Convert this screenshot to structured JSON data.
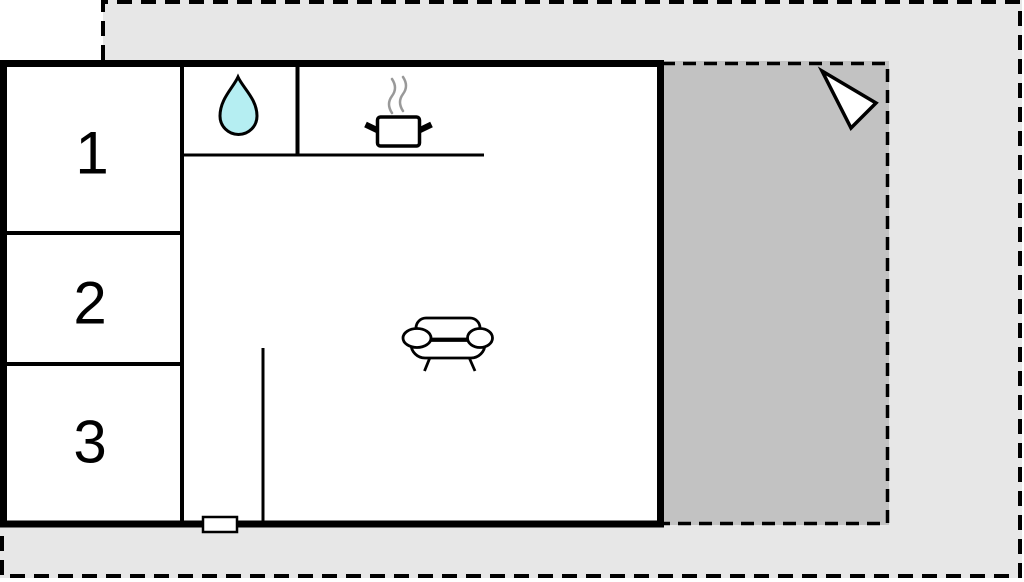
{
  "floorplan": {
    "type": "floor-plan-diagram",
    "rooms": [
      {
        "id": "room-1",
        "label": "1"
      },
      {
        "id": "room-2",
        "label": "2"
      },
      {
        "id": "room-3",
        "label": "3"
      }
    ],
    "icons": [
      {
        "name": "water-drop-icon",
        "meaning": "sink"
      },
      {
        "name": "pot-with-steam-icon",
        "meaning": "stove"
      },
      {
        "name": "sofa-icon",
        "meaning": "living-area"
      },
      {
        "name": "north-arrow-icon",
        "meaning": "orientation-arrow"
      }
    ],
    "colors": {
      "plot_light_gray": "#e7e7e7",
      "terrace_gray": "#c2c2c2",
      "wall_black": "#000000",
      "water_drop_cyan": "#b5eef2",
      "steam_gray": "#999999",
      "white": "#ffffff"
    }
  }
}
